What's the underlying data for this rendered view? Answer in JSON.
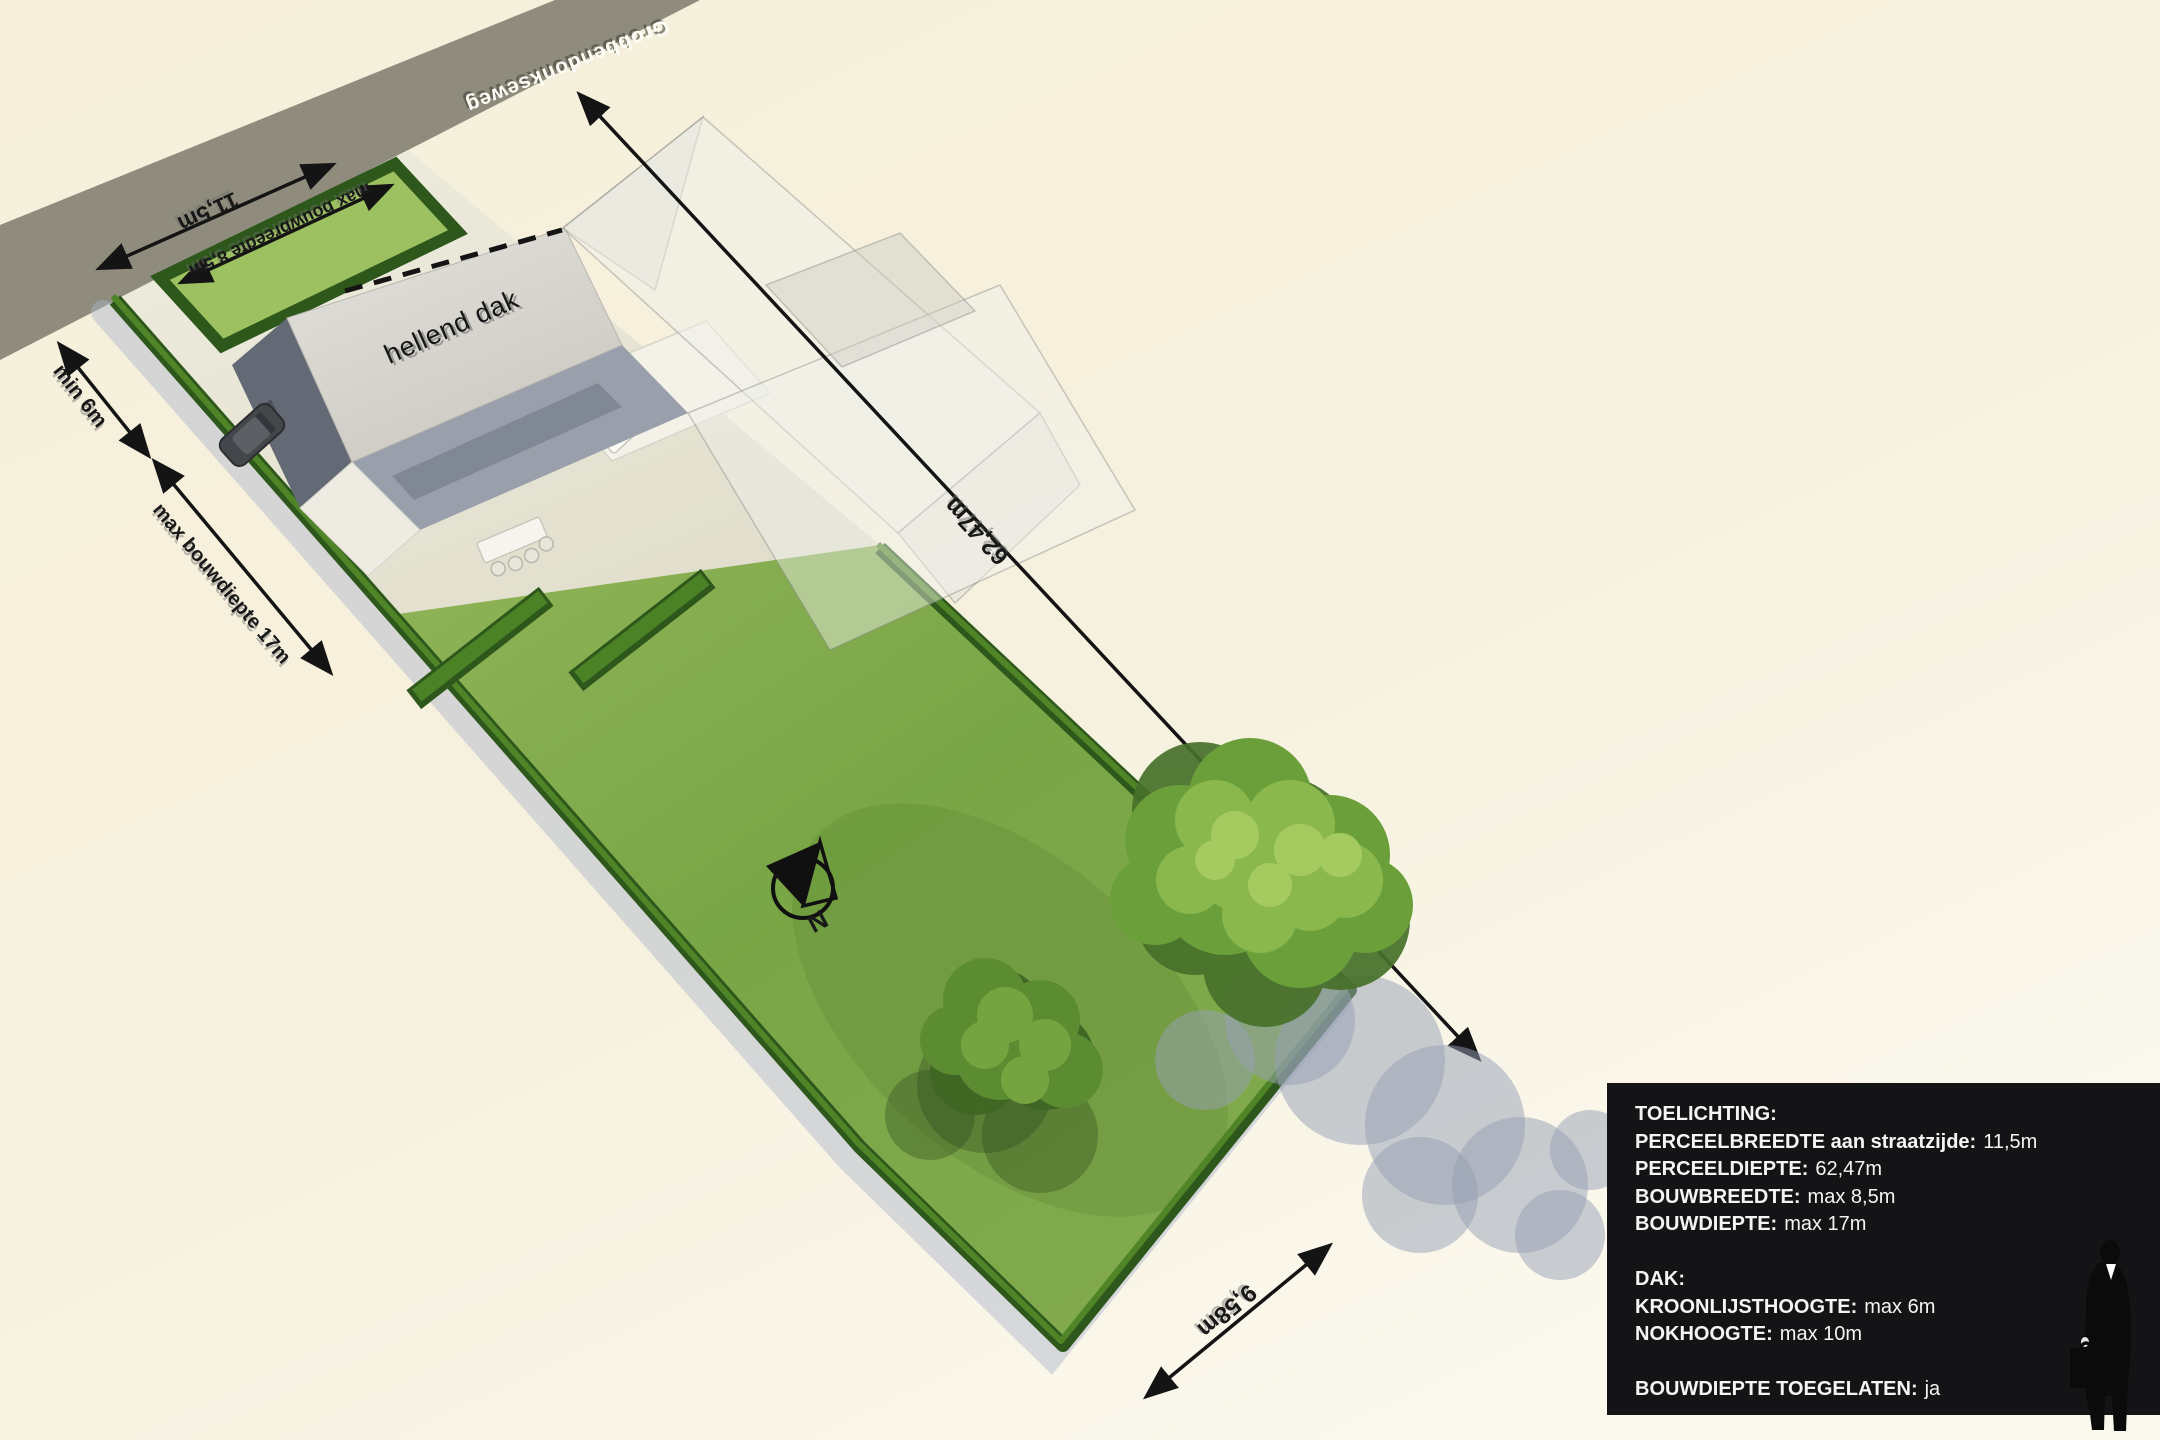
{
  "scene": {
    "street_name": "Grobbendonkseweg",
    "roof_label": "hellend dak",
    "compass_label": "N",
    "dimensions": {
      "street_width": "11,5m",
      "max_build_width": "max bouwbreedte 8,5m",
      "min_front_setback": "min 6m",
      "max_build_depth": "max bouwdiepte 17m",
      "plot_depth": "62,47m",
      "rear_width": "9,58m"
    },
    "colors": {
      "background": "#f6f1dc",
      "road": "#8f8c7d",
      "lawn": "#7da748",
      "hedge": "#2d571b",
      "pavement": "#e9e6d7",
      "roof": "#dad8d2",
      "facade": "#636a76",
      "ghost_envelope": "rgba(240,239,234,0.5)",
      "tree_shadow": "#96a0b4",
      "info_box_bg": "#141416",
      "info_box_text": "#f4f4f2"
    }
  },
  "info_box": {
    "lines": [
      {
        "label": "TOELICHTING:",
        "value": ""
      },
      {
        "label": "PERCEELBREEDTE aan straatzijde:",
        "value": "11,5m"
      },
      {
        "label": "PERCEELDIEPTE:",
        "value": "62,47m"
      },
      {
        "label": "BOUWBREEDTE:",
        "value": "max 8,5m"
      },
      {
        "label": "BOUWDIEPTE:",
        "value": "max 17m"
      },
      {
        "label": "DAK:",
        "value": ""
      },
      {
        "label": "KROONLIJSTHOOGTE:",
        "value": "max 6m"
      },
      {
        "label": "NOKHOOGTE:",
        "value": "max 10m"
      },
      {
        "label": "BOUWDIEPTE TOEGELATEN:",
        "value": "ja"
      }
    ]
  }
}
